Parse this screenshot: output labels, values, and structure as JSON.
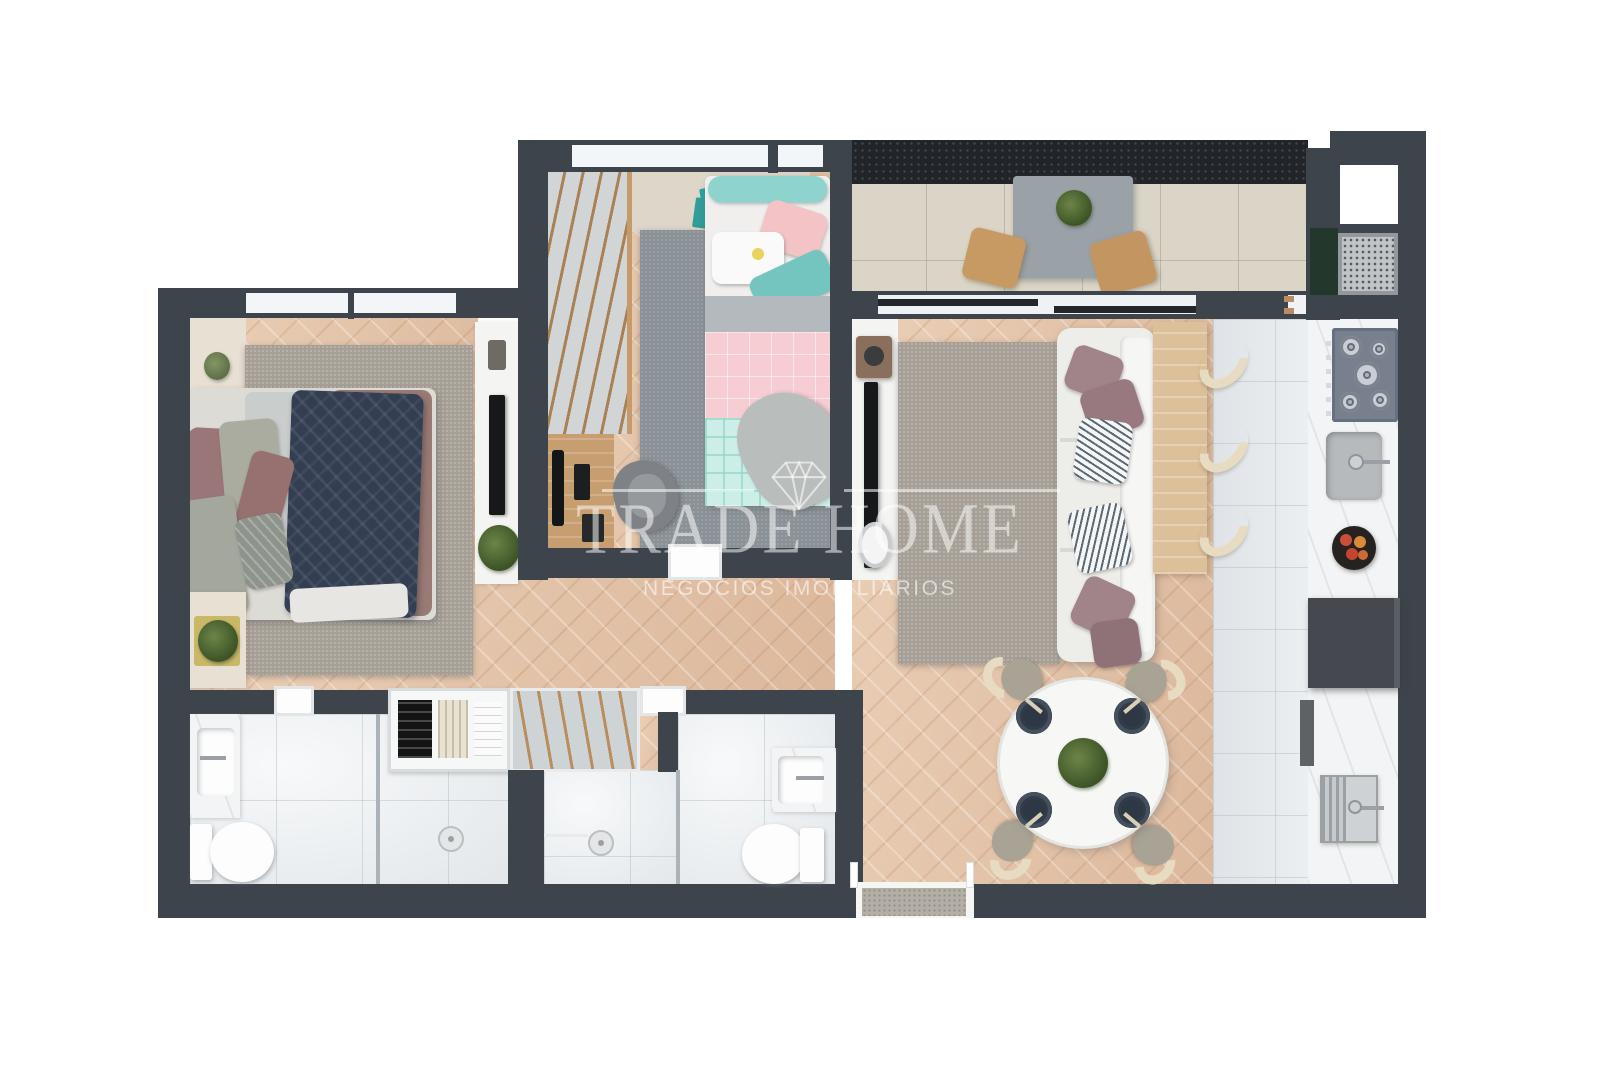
{
  "watermark": {
    "title": "TRADE HOME",
    "subtitle": "NEGÓCIOS IMOBILIÁRIOS",
    "icon": "diamond-gem-icon",
    "color": "#ffffff"
  },
  "palette": {
    "background": "#ffffff",
    "wall": "#3d444b",
    "granite_ledge": "#212529",
    "wood_floor": "#e4c5ab",
    "balcony_tile": "#dad5c6",
    "bathroom_tile": "#eef1f3",
    "kitchen_tile": "#e7eaed",
    "marble_counter": "#f3f4f5",
    "rug_warm_gray": "#a69f96",
    "rug_slate": "#8a9298",
    "sofa_white": "#ededea",
    "bed_quilt_navy": "#333e52",
    "accent_teal": "#7fd0cb",
    "accent_pink": "#f5cdd2",
    "accent_mauve": "#9b7678",
    "furniture_wood": "#c79e6f",
    "stool_cream": "#e7dcc2",
    "fridge_gray": "#45494f",
    "plant_green": "#3c5426"
  },
  "floor_plan": {
    "type": "apartment-top-view-3d-render",
    "rooms": [
      {
        "name": "master-bedroom",
        "furniture": [
          "double-bed",
          "navy-quilt",
          "pillows",
          "area-rug",
          "headboard-panel",
          "wall-tv",
          "plant",
          "bench-with-plant",
          "window"
        ]
      },
      {
        "name": "second-bedroom",
        "furniture": [
          "single-bed-teal-headboard",
          "open-wardrobe-rails",
          "wall-shelf",
          "desk-with-monitor",
          "desk-chair",
          "area-rug",
          "window"
        ]
      },
      {
        "name": "balcony",
        "furniture": [
          "granite-ledge",
          "table-with-plant",
          "wood-stool",
          "wood-stool",
          "sliding-door"
        ]
      },
      {
        "name": "living-room",
        "furniture": [
          "white-sofa",
          "throw-pillows",
          "area-rug",
          "wall-tv",
          "media-console",
          "decor-vase",
          "bar-counter",
          "bar-stool",
          "bar-stool",
          "bar-stool"
        ]
      },
      {
        "name": "dining-area",
        "furniture": [
          "round-table",
          "place-setting",
          "place-setting",
          "place-setting",
          "place-setting",
          "centerpiece-plant",
          "chair",
          "chair",
          "chair",
          "chair"
        ]
      },
      {
        "name": "kitchen",
        "furniture": [
          "gas-cooktop",
          "kitchen-sink",
          "fruit-bowl",
          "refrigerator",
          "laundry-sink",
          "marble-counter"
        ]
      },
      {
        "name": "service-area",
        "furniture": [
          "window-shaft",
          "ac-condenser-grille",
          "green-marble-ledge"
        ]
      },
      {
        "name": "bathroom-1",
        "furniture": [
          "vanity-sink",
          "toilet",
          "shower-with-drain",
          "glass-partition"
        ]
      },
      {
        "name": "closet-laundry",
        "furniture": [
          "shelves-with-folded-clothes",
          "drying-rack"
        ]
      },
      {
        "name": "bathroom-2",
        "furniture": [
          "shower-with-drain",
          "toilet",
          "vanity-sink"
        ]
      },
      {
        "name": "entry",
        "furniture": [
          "door-opening",
          "doormat"
        ]
      }
    ]
  }
}
